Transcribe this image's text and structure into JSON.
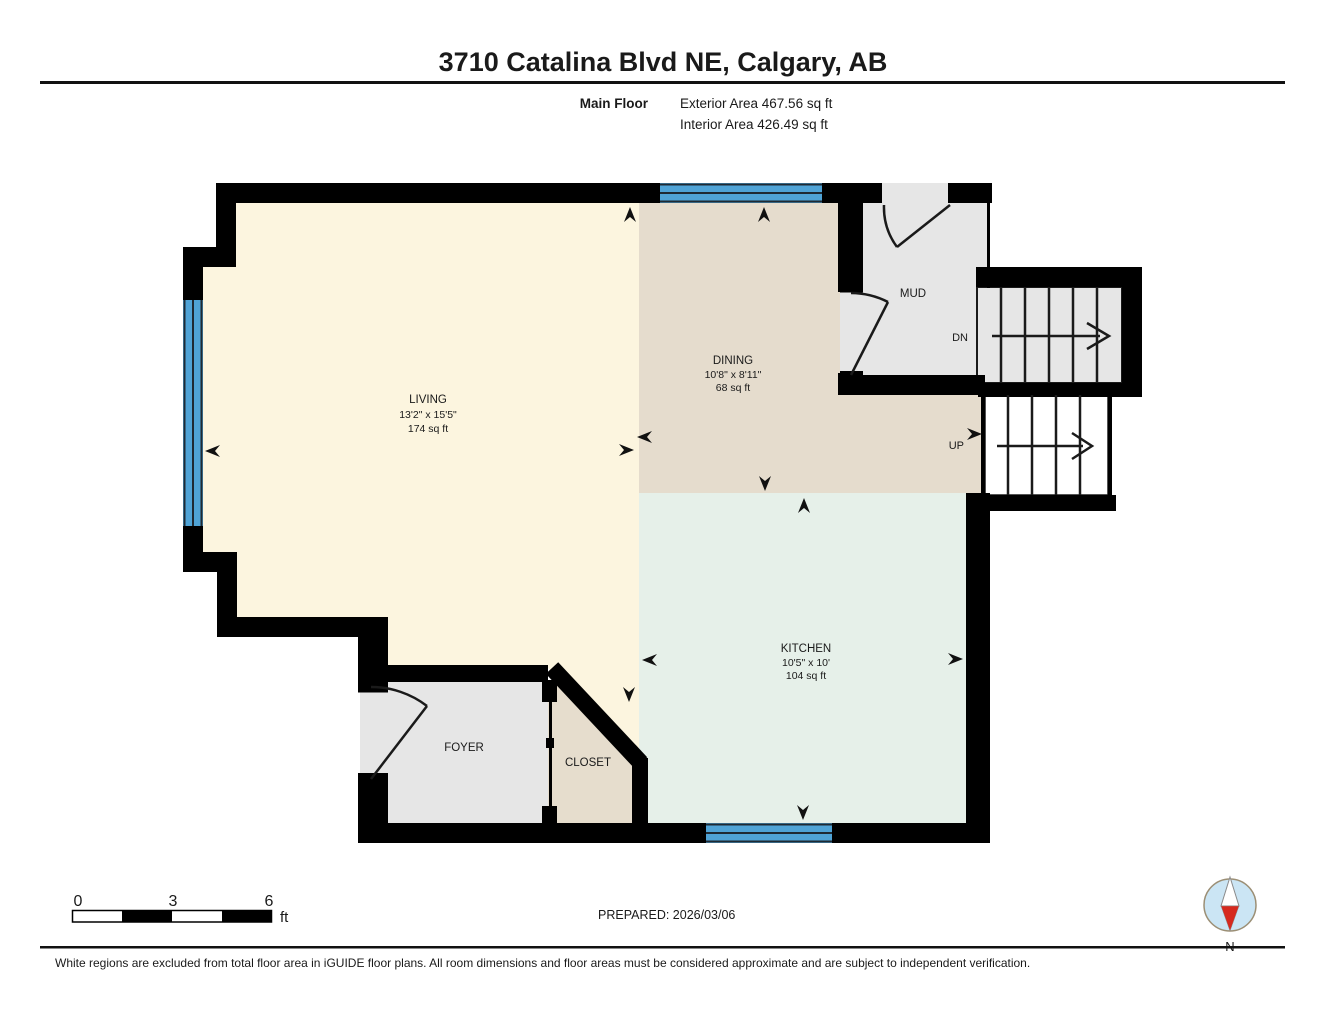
{
  "header": {
    "title": "3710 Catalina Blvd NE, Calgary, AB",
    "floor_label": "Main Floor",
    "exterior_area": "Exterior Area 467.56 sq ft",
    "interior_area": "Interior Area 426.49 sq ft"
  },
  "rooms": {
    "living": {
      "name": "LIVING",
      "dims": "13'2\" x 15'5\"",
      "area": "174 sq ft"
    },
    "dining": {
      "name": "DINING",
      "dims": "10'8\" x 8'11\"",
      "area": "68 sq ft"
    },
    "kitchen": {
      "name": "KITCHEN",
      "dims": "10'5\" x 10'",
      "area": "104 sq ft"
    },
    "mud": {
      "name": "MUD"
    },
    "foyer": {
      "name": "FOYER"
    },
    "closet": {
      "name": "CLOSET"
    }
  },
  "stairs": {
    "down": "DN",
    "up": "UP"
  },
  "scale_bar": {
    "ticks": [
      "0",
      "3",
      "6"
    ],
    "unit": "ft"
  },
  "compass": {
    "label": "N"
  },
  "footer": {
    "prepared": "PREPARED: 2026/03/06",
    "disclaimer": "White regions are excluded from total floor area in iGUIDE floor plans. All room dimensions and floor areas must be considered approximate and are subject to independent verification."
  },
  "colors": {
    "living": "#FCF5DF",
    "dining": "#E5DCCD",
    "kitchen": "#E6F0E9",
    "gray_room": "#E6E6E6",
    "closet": "#E6DDCD",
    "stair_white": "#FFFFFF",
    "window": "#4FA3D6",
    "wall": "#000000",
    "compass_fill": "#CBE5F4",
    "compass_needle": "#D6291E"
  }
}
